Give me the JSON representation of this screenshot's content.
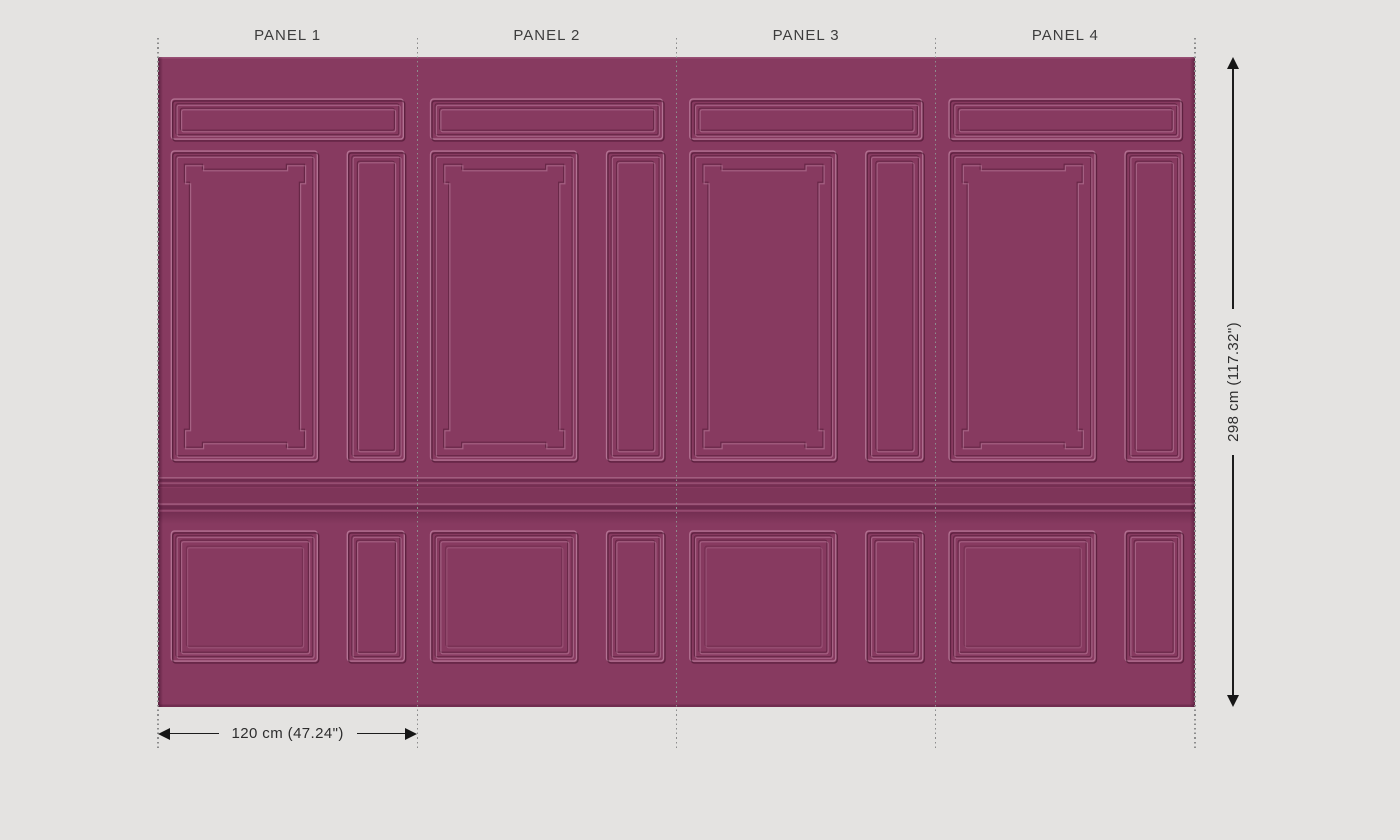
{
  "page": {
    "background_color": "#e4e3e1"
  },
  "wallpaper": {
    "base_color": "#873a60",
    "panel_count": 4,
    "panels": [
      {
        "label": "PANEL 1"
      },
      {
        "label": "PANEL 2"
      },
      {
        "label": "PANEL 3"
      },
      {
        "label": "PANEL 4"
      }
    ]
  },
  "dimensions": {
    "panel_width_label": "120 cm (47.24\")",
    "total_height_label": "298 cm (117.32\")"
  }
}
